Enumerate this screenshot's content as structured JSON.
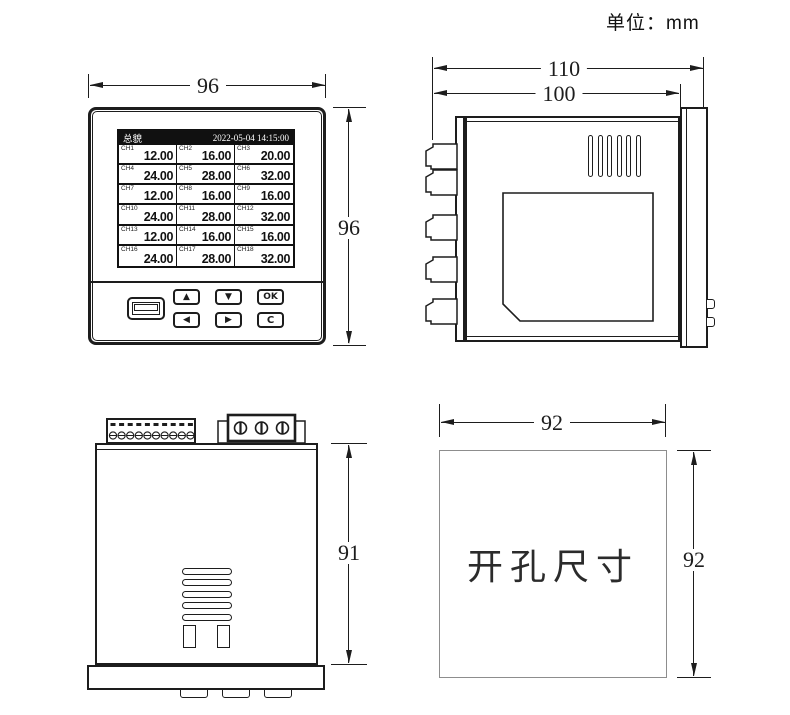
{
  "unit_label": "单位：mm",
  "colors": {
    "line": "#1d1d1d",
    "screen_header_bg": "#101010",
    "screen_header_text": "#ffffff",
    "cutout_border": "#8d8d8d"
  },
  "front_view": {
    "dim_width": "96",
    "dim_height": "96",
    "screen": {
      "title": "总貌",
      "datetime": "2022-05-04 14:15:00",
      "channels": [
        {
          "ch": "CH1",
          "value": "12.00"
        },
        {
          "ch": "CH2",
          "value": "16.00"
        },
        {
          "ch": "CH3",
          "value": "20.00"
        },
        {
          "ch": "CH4",
          "value": "24.00"
        },
        {
          "ch": "CH5",
          "value": "28.00"
        },
        {
          "ch": "CH6",
          "value": "32.00"
        },
        {
          "ch": "CH7",
          "value": "12.00"
        },
        {
          "ch": "CH8",
          "value": "16.00"
        },
        {
          "ch": "CH9",
          "value": "16.00"
        },
        {
          "ch": "CH10",
          "value": "24.00"
        },
        {
          "ch": "CH11",
          "value": "28.00"
        },
        {
          "ch": "CH12",
          "value": "32.00"
        },
        {
          "ch": "CH13",
          "value": "12.00"
        },
        {
          "ch": "CH14",
          "value": "16.00"
        },
        {
          "ch": "CH15",
          "value": "16.00"
        },
        {
          "ch": "CH16",
          "value": "24.00"
        },
        {
          "ch": "CH17",
          "value": "28.00"
        },
        {
          "ch": "CH18",
          "value": "32.00"
        }
      ]
    },
    "buttons": {
      "up": "▲",
      "down": "▼",
      "ok": "OK",
      "left": "◀",
      "right": "▶",
      "cancel": "C"
    }
  },
  "side_view": {
    "dim_overall": "110",
    "dim_body": "100"
  },
  "bottom_view": {
    "dim_body_depth": "91"
  },
  "cutout_view": {
    "label": "开孔尺寸",
    "dim_width": "92",
    "dim_height": "92"
  }
}
